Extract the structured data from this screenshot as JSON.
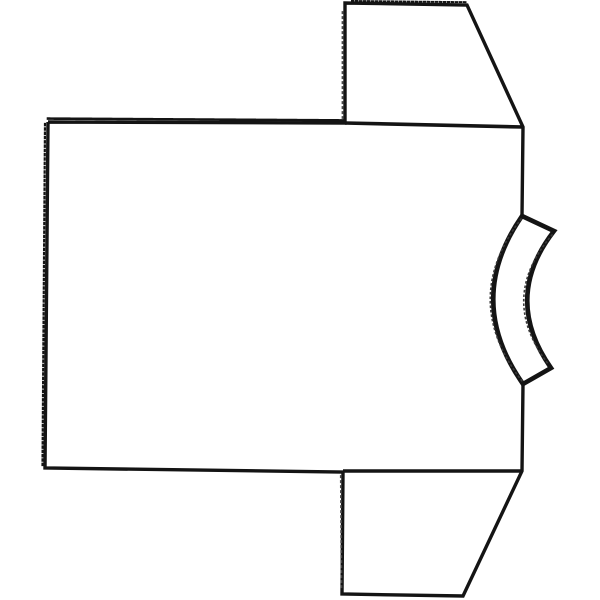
{
  "illustration": {
    "title": "t-shirt line drawing",
    "description": "Black ink line drawing of a short-sleeve T-shirt lying on its side, collar band on the right, sleeves pointing up and down, on a plain white background",
    "palette": {
      "paper": "#ffffff",
      "ink": "#141414",
      "faint_ink": "#4a4a4a",
      "fuzz_ink": "#3a3a3a"
    },
    "canvas": {
      "width": 600,
      "height": 600
    },
    "shapes": [
      {
        "name": "tshirt-body-silhouette",
        "d": "M48,122 L345,123 L345,3 L467,5 L523,127 L522,216 M523,384 L522,471 L463,596 L342,594 L343,472 L45,468 L48,122",
        "width": 3.4
      },
      {
        "name": "top-sleeve-seam-line",
        "d": "M345,123 L523,127",
        "width": 3.6
      },
      {
        "name": "bottom-sleeve-seam-line",
        "d": "M343,471 L523,471",
        "width": 3.6
      },
      {
        "name": "collar-band",
        "d": "M522,216 L554,231 Q502,298 551,368 L523,384 Q464,300 522,216 Z",
        "width": 4.6,
        "fill": "#ffffff"
      },
      {
        "name": "body-top-edge-teeth",
        "d": "M48,118.6 L345,120.4",
        "width": 2.6,
        "dash": "1.5 2.1"
      },
      {
        "name": "body-left-edge-teeth",
        "d": "M45,124 L42.5,466",
        "width": 2.2,
        "dash": "1.3 3"
      },
      {
        "name": "top-sleeve-top-edge-teeth",
        "d": "M352,1 L466,2.2",
        "width": 2,
        "dash": "1.5 2.5"
      },
      {
        "name": "top-sleeve-fold-dots",
        "d": "M342.5,12 L342.5,118",
        "width": 1.8,
        "dash": "1.2 3.8",
        "color": "#4a4a4a"
      },
      {
        "name": "bottom-sleeve-fold-dots",
        "d": "M340.8,476 L341.5,590",
        "width": 1.8,
        "dash": "1.2 3.8",
        "color": "#4a4a4a"
      },
      {
        "name": "collar-outer-edge-fuzz",
        "d": "M521,219 Q459,300 522,381",
        "width": 1.6,
        "dash": "1 3.5",
        "color": "#3a3a3a"
      },
      {
        "name": "collar-inner-edge-fuzz",
        "d": "M552,235 Q497,299 549,365",
        "width": 1.6,
        "dash": "1 3.5",
        "color": "#3a3a3a"
      }
    ]
  }
}
